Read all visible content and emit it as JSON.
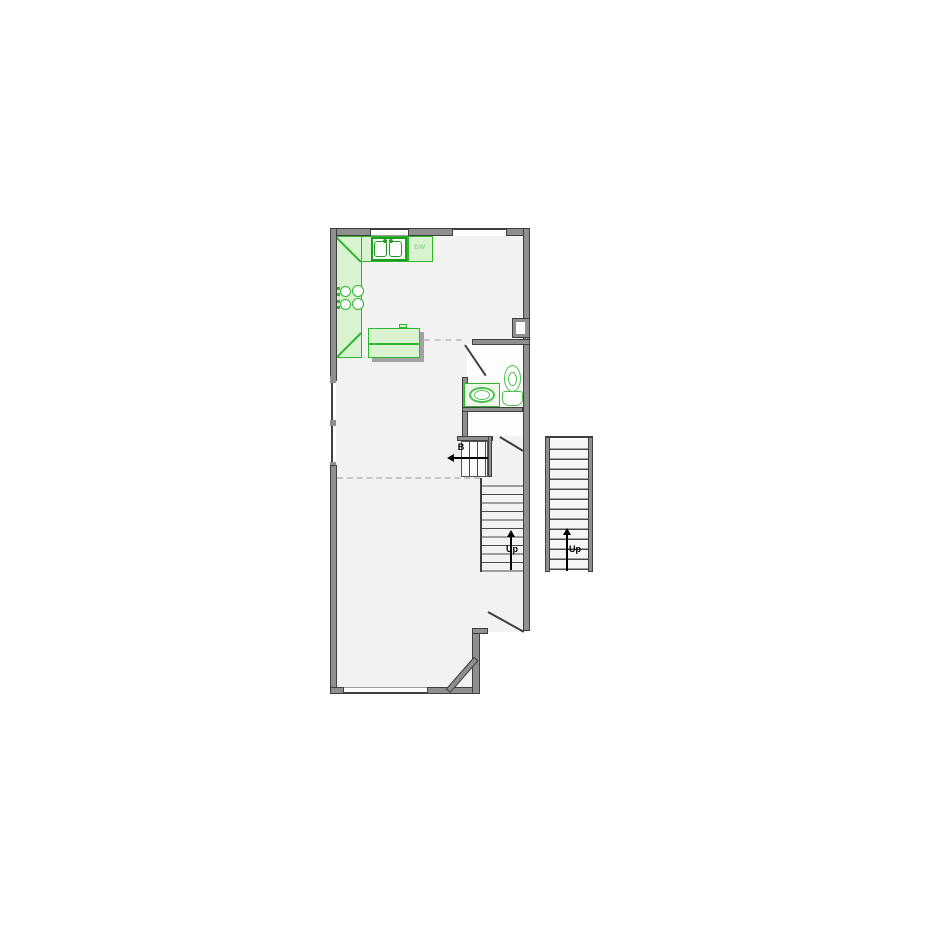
{
  "plan": {
    "title": "first-floor-plan",
    "labels": {
      "dishwasher": "DW",
      "basement_direction": "B",
      "stairs_up_main": "Up",
      "stairs_up_exterior": "Up"
    },
    "fixtures": {
      "kitchen": [
        "double-basin-sink",
        "dishwasher",
        "cooktop-4-burner",
        "kitchen-island",
        "l-shaped-counter"
      ],
      "bathroom": [
        "toilet",
        "vanity-sink"
      ],
      "circulation": [
        "main-stairs-up",
        "basement-stairs-down",
        "exterior-stairs-up"
      ]
    },
    "colors": {
      "wall_fill": "#8f8f8f",
      "wall_edge": "#3f3f3f",
      "fixture_green": "#2eb82e",
      "fixture_green_dark": "#1d9e1d",
      "fixture_green_fill": "#d9f2cf",
      "toilet_green": "#4cc24c",
      "label_green": "#8fd98f",
      "floor": "#f2f2f1",
      "dashed_line": "#c6c6c6",
      "text": "#000000"
    }
  }
}
